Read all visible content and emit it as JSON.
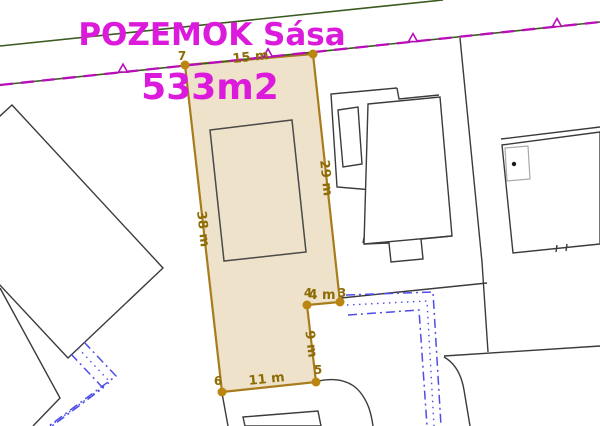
{
  "map": {
    "title": "POZEMOK Sása",
    "area": "533m2",
    "dimensions": {
      "top": "15 m",
      "right": "29 m",
      "left": "38 m",
      "notch": "4 m",
      "notch_side": "9 m",
      "bottom": "11 m"
    },
    "vertices": {
      "v7": "7",
      "v3": "3",
      "v4": "4",
      "v5": "5",
      "v6": "6"
    },
    "colors": {
      "title_text": "#DC1ADC",
      "parcel_fill": "#EEE2CA",
      "parcel_stroke": "#A87C1C",
      "vertex_dot": "#BB8512",
      "dimension_text": "#8E6B04",
      "cadastral_boundary_magenta": "#B80DB8",
      "cadastral_boundary_green": "#3A5A1E",
      "building_line": "#3B3B3B",
      "ekn_parcel_blue": "#4D4DE8"
    }
  }
}
